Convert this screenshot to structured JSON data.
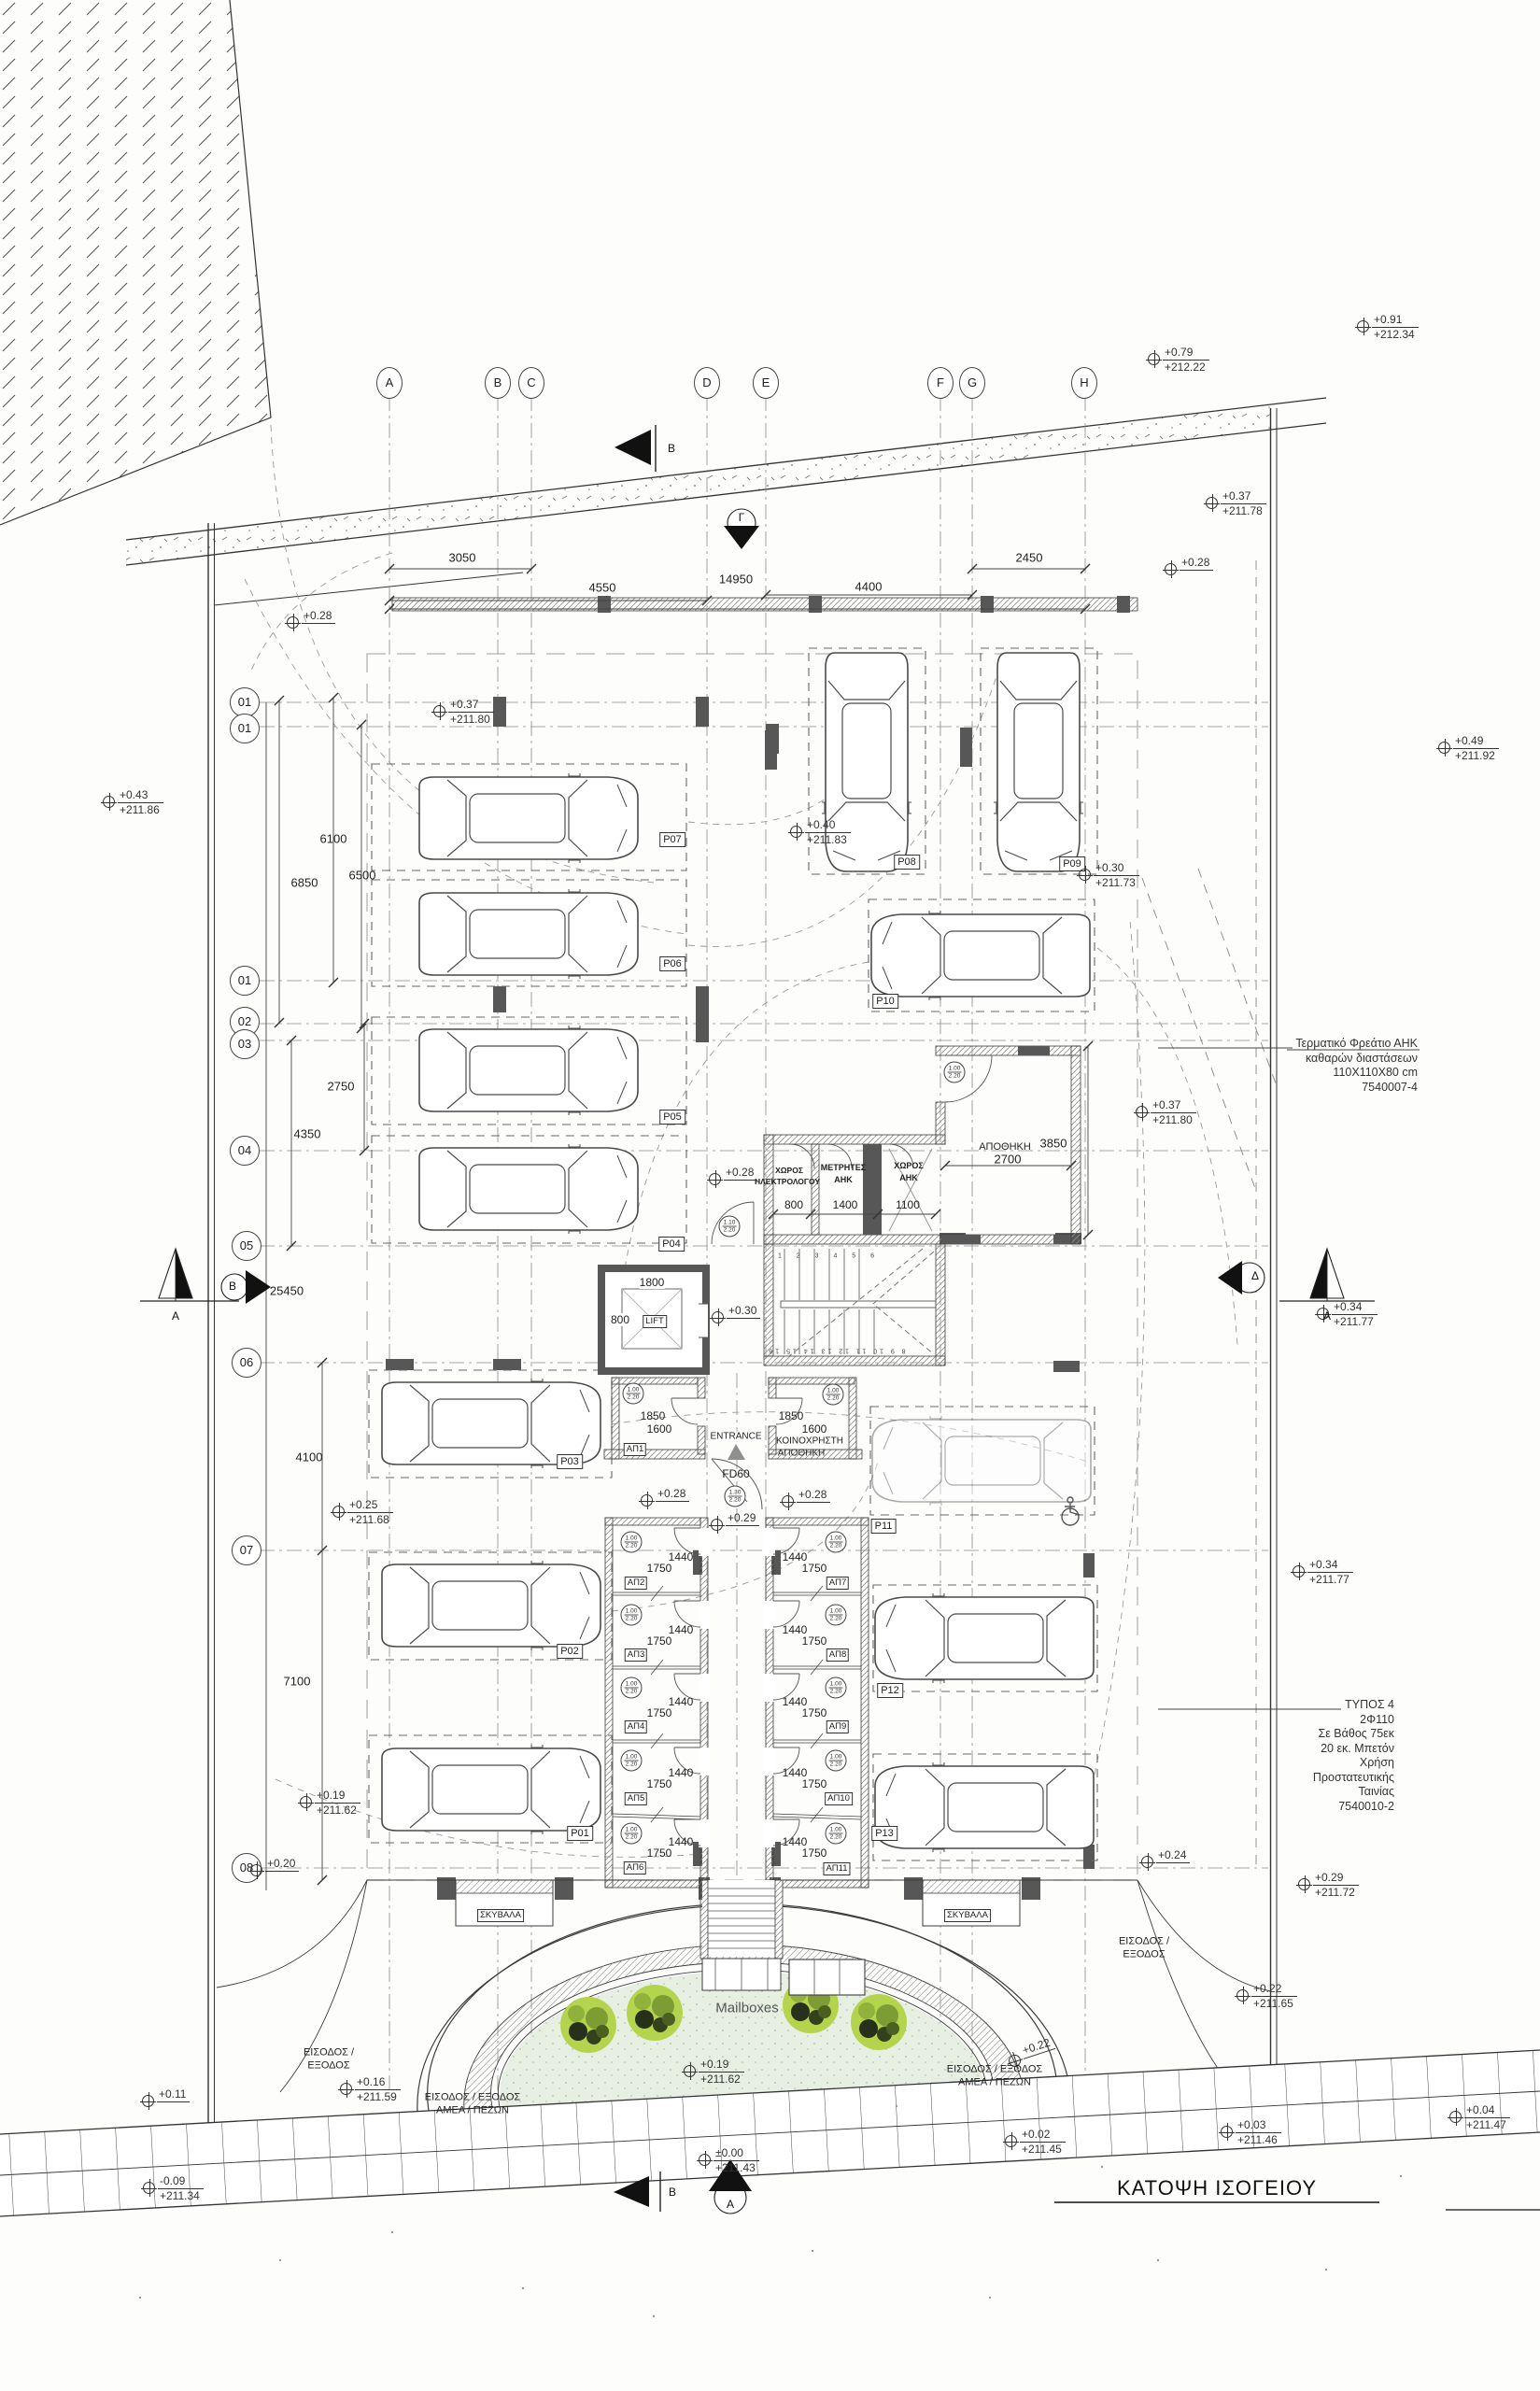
{
  "title": "ΚΑΤΟΨΗ ΙΣΟΓΕΙΟΥ",
  "grid": {
    "cols": [
      "A",
      "B",
      "C",
      "D",
      "E",
      "F",
      "G",
      "H"
    ],
    "rows": [
      "01",
      "01",
      "01",
      "02",
      "03",
      "04",
      "05",
      "06",
      "07",
      "08"
    ]
  },
  "parking": {
    "p01": "P01",
    "p02": "P02",
    "p03": "P03",
    "p04": "P04",
    "p05": "P05",
    "p06": "P06",
    "p07": "P07",
    "p08": "P08",
    "p09": "P09",
    "p10": "P10",
    "p11": "P11",
    "p12": "P12",
    "p13": "P13"
  },
  "storage": {
    "ap1": "ΑΠ1",
    "ap2": "ΑΠ2",
    "ap3": "ΑΠ3",
    "ap4": "ΑΠ4",
    "ap5": "ΑΠ5",
    "ap6": "ΑΠ6",
    "ap7": "ΑΠ7",
    "ap8": "ΑΠ8",
    "ap9": "ΑΠ9",
    "ap10": "ΑΠ10",
    "ap11": "ΑΠ11",
    "koin1": "ΚΟΙΝΟΧΡΗΣΤΗ",
    "koin2": "ΑΠΟΘΗΚΗ",
    "apothiki": "ΑΠΟΘΗΚΗ"
  },
  "rooms": {
    "xoros1a": "ΧΩΡΟΣ",
    "xoros1b": "ΗΛΕΚΤΡΟΛΟΓΟΥ",
    "metr1": "ΜΕΤΡΗΤΕΣ",
    "metr2": "ΑΗΚ",
    "xoros2a": "ΧΩΡΟΣ",
    "xoros2b": "ΑΗΚ",
    "lift": "LIFT",
    "entrance": "ENTRANCE",
    "fd60": "FD60",
    "mailboxes": "Mailboxes",
    "skybala": "ΣΚΥΒΑΛΑ"
  },
  "dims": {
    "d3050": "3050",
    "d4550": "4550",
    "d14950": "14950",
    "d4400": "4400",
    "d2450": "2450",
    "d6100": "6100",
    "d6850": "6850",
    "d6500": "6500",
    "d2750": "2750",
    "d4350": "4350",
    "d25450": "25450",
    "d4100": "4100",
    "d7100": "7100",
    "d1800": "1800",
    "d800l": "800",
    "d1850": "1850",
    "d1600": "1600",
    "d1440": "1440",
    "d1750": "1750",
    "d800": "800",
    "d1400": "1400",
    "d1100": "1100",
    "d2700": "2700",
    "d3850": "3850"
  },
  "elev": {
    "e1": {
      "rel": "+0.91",
      "abs": "+212.34"
    },
    "e2": {
      "rel": "+0.79",
      "abs": "+212.22"
    },
    "e3": {
      "rel": "+0.37",
      "abs": "+211.78"
    },
    "e4": {
      "rel": "+0.28"
    },
    "e5": {
      "rel": "+0.28"
    },
    "e6": {
      "rel": "+0.37",
      "abs": "+211.80"
    },
    "e7": {
      "rel": "+0.43",
      "abs": "+211.86"
    },
    "e8": {
      "rel": "+0.49",
      "abs": "+211.92"
    },
    "e9": {
      "rel": "+0.40",
      "abs": "+211.83"
    },
    "e10": {
      "rel": "+0.30",
      "abs": "+211.73"
    },
    "e11": {
      "rel": "+0.37",
      "abs": "+211.80"
    },
    "e12": {
      "rel": "+0.28"
    },
    "e13": {
      "rel": "+0.30"
    },
    "e14": {
      "rel": "+0.34",
      "abs": "+211.77"
    },
    "e15": {
      "rel": "+0.25",
      "abs": "+211.68"
    },
    "e16": {
      "rel": "+0.28"
    },
    "e17": {
      "rel": "+0.29"
    },
    "e18": {
      "rel": "+0.28"
    },
    "e19": {
      "rel": "+0.34",
      "abs": "+211.77"
    },
    "e20": {
      "rel": "+0.19",
      "abs": "+211.62"
    },
    "e21": {
      "rel": "+0.20"
    },
    "e22": {
      "rel": "+0.24"
    },
    "e23": {
      "rel": "+0.29",
      "abs": "+211.72"
    },
    "e24": {
      "rel": "+0.22",
      "abs": "+211.65"
    },
    "e25": {
      "rel": "+0.22"
    },
    "e26": {
      "rel": "+0.16",
      "abs": "+211.59"
    },
    "e27": {
      "rel": "+0.11"
    },
    "e28": {
      "rel": "-0.09",
      "abs": "+211.34"
    },
    "e29": {
      "rel": "+0.19",
      "abs": "+211.62"
    },
    "e30": {
      "rel": "±0.00",
      "abs": "+211.43"
    },
    "e31": {
      "rel": "+0.02",
      "abs": "+211.45"
    },
    "e32": {
      "rel": "+0.03",
      "abs": "+211.46"
    },
    "e33": {
      "rel": "+0.04",
      "abs": "+211.47"
    }
  },
  "notes": {
    "ahk": [
      "Τερματικό Φρεάτιο ΑΗΚ",
      "καθαρών διαστάσεων",
      "110X110X80 cm",
      "7540007-4"
    ],
    "typos": [
      "ΤΥΠΟΣ 4",
      "2Φ110",
      "Σε Βάθος 75εκ",
      "20 εκ. Μπετόν",
      "Χρήση",
      "Προστατευτικής",
      "Ταινίας",
      "7540010-2"
    ]
  },
  "entrances": {
    "left": [
      "ΕΙΣΟΔΟΣ /",
      "ΕΞΟΔΟΣ"
    ],
    "mid_left": [
      "ΕΙΣΟΔΟΣ / ΕΞΟΔΟΣ",
      "ΑΜΕΑ / ΠΕΖΩΝ"
    ],
    "mid_right": [
      "ΕΙΣΟΔΟΣ / ΕΞΟΔΟΣ",
      "ΑΜΕΑ / ΠΕΖΩΝ"
    ],
    "right": [
      "ΕΙΣΟΔΟΣ /",
      "ΕΞΟΔΟΣ"
    ]
  },
  "markers": {
    "a": "A",
    "b": "B",
    "gamma": "Γ",
    "delta": "Δ"
  },
  "door_tags": {
    "w100": "1.00",
    "w110": "1.10",
    "w130": "1.30",
    "h": "2.20"
  },
  "stairs": {
    "top": "1 2 3 4 5 6",
    "bottom": "8 9 10 11 12 13 14 15 16"
  }
}
